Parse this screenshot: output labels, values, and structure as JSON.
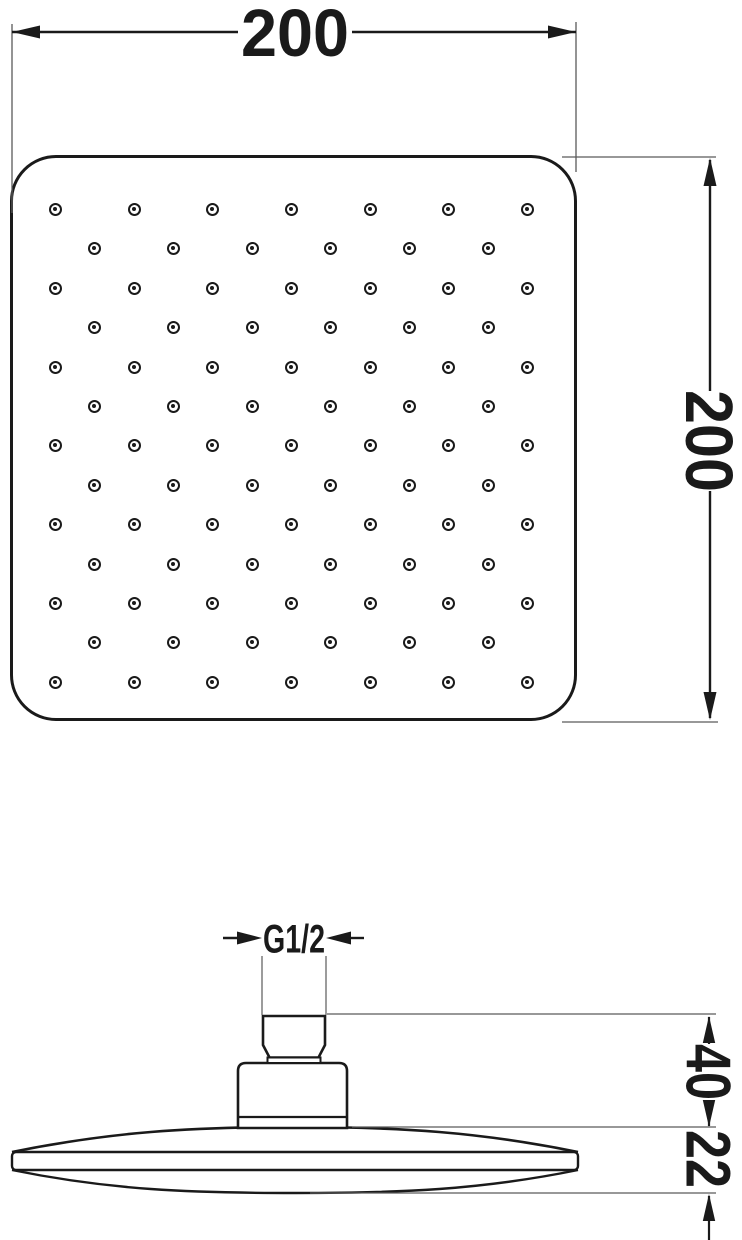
{
  "drawing_title": "square shower head dimensional drawing",
  "dimensions": {
    "width_mm": "200",
    "height_mm": "200",
    "thread": "G1/2",
    "mount_height_mm": "40",
    "disc_thickness_mm": "22"
  },
  "nozzle_grid": {
    "rows_y": [
      209,
      248,
      288,
      327,
      367,
      406,
      445,
      485,
      524,
      564,
      603,
      642,
      682
    ],
    "odd_row_xs": [
      55,
      134,
      212,
      291,
      370,
      448,
      527
    ],
    "even_row_xs": [
      94,
      173,
      252,
      330,
      409,
      488
    ],
    "dot_outer_px": 13,
    "dot_inner_px": 4
  },
  "colors": {
    "line": "#1a1a1a",
    "thin_line": "#5a5a5a",
    "background": "#ffffff"
  }
}
